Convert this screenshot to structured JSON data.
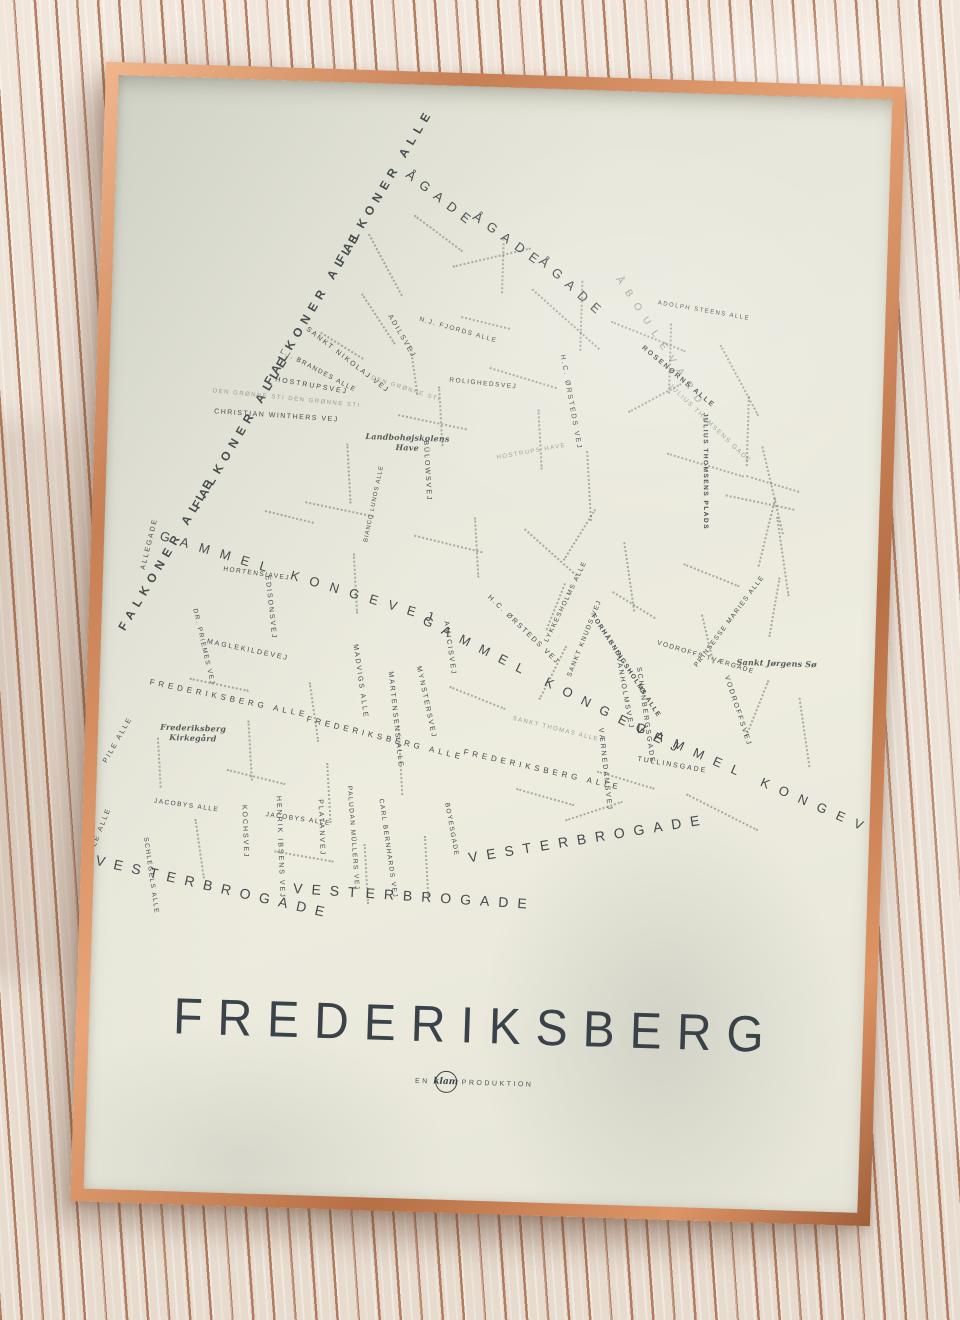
{
  "poster": {
    "title": "FREDERIKSBERG",
    "credit_prefix": "EN",
    "credit_logo": "klam",
    "credit_suffix": "PRODUKTION",
    "colors": {
      "paper": "#eae9dd",
      "ink": "#454b4c",
      "ink_light": "#9aa096",
      "frame_copper": "#c77f54",
      "fabric_base": "#eee3d8",
      "fabric_stripe": "#a86c4c"
    },
    "map": {
      "landmarks": [
        {
          "text": "Frederiksberg\nKirkegård",
          "x": 62,
          "y": 645
        },
        {
          "text": "Landbohøjskolens\nHave",
          "x": 258,
          "y": 348
        },
        {
          "text": "Sankt Jørgens Sø",
          "x": 636,
          "y": 562
        }
      ],
      "streets": [
        {
          "t": "ÅGADE",
          "x": 292,
          "y": 82,
          "r": 36,
          "s": 13,
          "ls": 8,
          "w": "n",
          "c": "dark"
        },
        {
          "t": "ÅGADE",
          "x": 360,
          "y": 122,
          "r": 34,
          "s": 13,
          "ls": 8,
          "w": "n",
          "c": "dark"
        },
        {
          "t": "ÅGADE",
          "x": 428,
          "y": 164,
          "r": 40,
          "s": 13,
          "ls": 8,
          "w": "n",
          "c": "dark"
        },
        {
          "t": "ÅBOULEVARD",
          "x": 505,
          "y": 182,
          "r": 55,
          "s": 10,
          "ls": 9,
          "w": "n",
          "c": "light"
        },
        {
          "t": "FALKONER ALLE",
          "x": 20,
          "y": 548,
          "r": -61,
          "s": 12,
          "ls": 6,
          "w": "b",
          "c": "dark"
        },
        {
          "t": "FALKONER ALLE",
          "x": 90,
          "y": 424,
          "r": -61,
          "s": 12,
          "ls": 6,
          "w": "b",
          "c": "dark"
        },
        {
          "t": "FALKONER ALLE",
          "x": 158,
          "y": 298,
          "r": -61,
          "s": 12,
          "ls": 6,
          "w": "b",
          "c": "dark"
        },
        {
          "t": "FALKONER ALLE",
          "x": 226,
          "y": 174,
          "r": -61,
          "s": 12,
          "ls": 6,
          "w": "b",
          "c": "dark"
        },
        {
          "t": "GAMMEL KONGEVEJ",
          "x": 56,
          "y": 452,
          "r": 15,
          "s": 13,
          "ls": 11,
          "w": "n",
          "c": "dark"
        },
        {
          "t": "GAMMEL KONGEVEJ",
          "x": 322,
          "y": 528,
          "r": 25,
          "s": 13,
          "ls": 11,
          "w": "n",
          "c": "dark"
        },
        {
          "t": "GAMMEL KONGEVEJ",
          "x": 538,
          "y": 628,
          "r": 22,
          "s": 13,
          "ls": 11,
          "w": "n",
          "c": "dark"
        },
        {
          "t": "FREDERIKSBERG ALLE",
          "x": 50,
          "y": 602,
          "r": 10,
          "s": 8,
          "ls": 4,
          "w": "n",
          "c": "dark"
        },
        {
          "t": "FREDERIKSBERG ALLE",
          "x": 208,
          "y": 634,
          "r": 12,
          "s": 8,
          "ls": 4,
          "w": "n",
          "c": "dark"
        },
        {
          "t": "FREDERIKSBERG ALLE",
          "x": 366,
          "y": 662,
          "r": 11,
          "s": 8,
          "ls": 4,
          "w": "n",
          "c": "dark"
        },
        {
          "t": "VESTERBROGADE",
          "x": 2,
          "y": 778,
          "r": 11,
          "s": 14,
          "ls": 9,
          "w": "n",
          "c": "dark"
        },
        {
          "t": "VESTERBROGADE",
          "x": 200,
          "y": 800,
          "r": 2,
          "s": 14,
          "ls": 9,
          "w": "n",
          "c": "dark"
        },
        {
          "t": "VESTERBROGADE",
          "x": 374,
          "y": 764,
          "r": -11,
          "s": 14,
          "ls": 9,
          "w": "n",
          "c": "dark"
        },
        {
          "t": "SANKT NIKOLAJ VEJ",
          "x": 196,
          "y": 244,
          "r": 36,
          "s": 7,
          "ls": 2,
          "w": "n",
          "c": "dark"
        },
        {
          "t": "HOSTRUPSVEJ",
          "x": 166,
          "y": 296,
          "r": 8,
          "s": 7,
          "ls": 2,
          "w": "n",
          "c": "dark"
        },
        {
          "t": "DEN GRØNNE STI DEN GRØNNE STI",
          "x": 104,
          "y": 310,
          "r": 4,
          "s": 6,
          "ls": 1.5,
          "w": "n",
          "c": "light"
        },
        {
          "t": "CHRISTIAN WINTHERS VEJ",
          "x": 106,
          "y": 330,
          "r": 2,
          "s": 7,
          "ls": 1.5,
          "w": "n",
          "c": "dark"
        },
        {
          "t": "ADILSVEJ",
          "x": 278,
          "y": 228,
          "r": 58,
          "s": 7,
          "ls": 2,
          "w": "n",
          "c": "dark"
        },
        {
          "t": "L.I. BRANDES ALLE",
          "x": 170,
          "y": 268,
          "r": 26,
          "s": 6.5,
          "ls": 1.5,
          "w": "n",
          "c": "dark"
        },
        {
          "t": "N.J. FJORDS ALLE",
          "x": 308,
          "y": 232,
          "r": 14,
          "s": 6.5,
          "ls": 1.5,
          "w": "n",
          "c": "dark"
        },
        {
          "t": "DEN GRØNNE STI",
          "x": 262,
          "y": 292,
          "r": 16,
          "s": 6,
          "ls": 1.5,
          "w": "n",
          "c": "light"
        },
        {
          "t": "ROLIGHEDSVEJ",
          "x": 340,
          "y": 292,
          "r": 4,
          "s": 6.5,
          "ls": 1.5,
          "w": "n",
          "c": "dark"
        },
        {
          "t": "BÜLOWSVEJ",
          "x": 318,
          "y": 352,
          "r": 85,
          "s": 7,
          "ls": 2,
          "w": "n",
          "c": "dark"
        },
        {
          "t": "HOSTRUPS HAVE",
          "x": 390,
          "y": 368,
          "r": -12,
          "s": 6,
          "ls": 1.5,
          "w": "n",
          "c": "light"
        },
        {
          "t": "H.C. ØRSTEDS VEJ",
          "x": 452,
          "y": 262,
          "r": 78,
          "s": 7,
          "ls": 2,
          "w": "n",
          "c": "dark"
        },
        {
          "t": "H.C. ØRSTEDS VEJ",
          "x": 386,
          "y": 506,
          "r": 42,
          "s": 7,
          "ls": 2,
          "w": "n",
          "c": "dark"
        },
        {
          "t": "JULIUS THOMSENS GADE",
          "x": 560,
          "y": 290,
          "r": 42,
          "s": 6.5,
          "ls": 1.5,
          "w": "n",
          "c": "light"
        },
        {
          "t": "JULIUS THOMSENS PLADS",
          "x": 596,
          "y": 316,
          "r": 88,
          "s": 6.5,
          "ls": 1.5,
          "w": "b",
          "c": "dark"
        },
        {
          "t": "ADOLPH STEENS ALLE",
          "x": 546,
          "y": 208,
          "r": 8,
          "s": 6,
          "ls": 1.5,
          "w": "n",
          "c": "dark"
        },
        {
          "t": "ROSENØRNS ALLE",
          "x": 532,
          "y": 252,
          "r": 38,
          "s": 7,
          "ls": 2,
          "w": "b",
          "c": "dark"
        },
        {
          "t": "FORHÅBNINGSHOLMS ALLE",
          "x": 490,
          "y": 522,
          "r": 55,
          "s": 6.5,
          "ls": 1.5,
          "w": "b",
          "c": "dark"
        },
        {
          "t": "VODROFFS TVÆRGADE",
          "x": 556,
          "y": 548,
          "r": 15,
          "s": 6.5,
          "ls": 1.5,
          "w": "n",
          "c": "dark"
        },
        {
          "t": "VODROFFSVEJ",
          "x": 626,
          "y": 578,
          "r": 70,
          "s": 7,
          "ls": 2,
          "w": "n",
          "c": "dark"
        },
        {
          "t": "SVANHOLMSVEJ",
          "x": 516,
          "y": 556,
          "r": 78,
          "s": 7,
          "ls": 2,
          "w": "n",
          "c": "dark"
        },
        {
          "t": "SCHØNBERGSGADE",
          "x": 538,
          "y": 572,
          "r": 80,
          "s": 7,
          "ls": 2,
          "w": "n",
          "c": "dark"
        },
        {
          "t": "PRINSESSE MARIES ALLE",
          "x": 596,
          "y": 570,
          "r": -55,
          "s": 6.5,
          "ls": 1.5,
          "w": "n",
          "c": "dark"
        },
        {
          "t": "LYKKESHOLMS ALLE",
          "x": 446,
          "y": 550,
          "r": -66,
          "s": 6.5,
          "ls": 1.5,
          "w": "n",
          "c": "dark"
        },
        {
          "t": "SANKT KNUDS VEJ",
          "x": 470,
          "y": 584,
          "r": -70,
          "s": 6.5,
          "ls": 1.5,
          "w": "n",
          "c": "dark"
        },
        {
          "t": "BIANCO LUNOS ALLE",
          "x": 262,
          "y": 456,
          "r": -80,
          "s": 6,
          "ls": 1,
          "w": "n",
          "c": "dark"
        },
        {
          "t": "EDISONSVEJ",
          "x": 164,
          "y": 492,
          "r": 82,
          "s": 7,
          "ls": 2,
          "w": "n",
          "c": "dark"
        },
        {
          "t": "HORTENSIAVEJ",
          "x": 120,
          "y": 488,
          "r": 6,
          "s": 6.5,
          "ls": 1.5,
          "w": "n",
          "c": "dark"
        },
        {
          "t": "MAGLEKILDEVEJ",
          "x": 106,
          "y": 560,
          "r": 10,
          "s": 7,
          "ls": 2,
          "w": "n",
          "c": "dark"
        },
        {
          "t": "DR. PRIEMES VEJ",
          "x": 92,
          "y": 528,
          "r": 75,
          "s": 6.5,
          "ls": 1.5,
          "w": "n",
          "c": "dark"
        },
        {
          "t": "ALLEGADE",
          "x": 40,
          "y": 490,
          "r": -78,
          "s": 7,
          "ls": 2,
          "w": "n",
          "c": "dark"
        },
        {
          "t": "AMICISVEJ",
          "x": 344,
          "y": 532,
          "r": 80,
          "s": 7,
          "ls": 2,
          "w": "n",
          "c": "dark"
        },
        {
          "t": "MADVIGS ALLE",
          "x": 254,
          "y": 558,
          "r": 80,
          "s": 7,
          "ls": 2,
          "w": "n",
          "c": "dark"
        },
        {
          "t": "MARTENSENS ALLE",
          "x": 290,
          "y": 584,
          "r": 82,
          "s": 7,
          "ls": 2,
          "w": "n",
          "c": "dark"
        },
        {
          "t": "MYNSTERSVEJ",
          "x": 318,
          "y": 578,
          "r": 76,
          "s": 7,
          "ls": 2,
          "w": "n",
          "c": "dark"
        },
        {
          "t": "VÆRNEDAMSVEJ",
          "x": 502,
          "y": 634,
          "r": 82,
          "s": 7,
          "ls": 2,
          "w": "n",
          "c": "dark"
        },
        {
          "t": "TULLINSGADE",
          "x": 540,
          "y": 664,
          "r": 8,
          "s": 7,
          "ls": 2,
          "w": "n",
          "c": "dark"
        },
        {
          "t": "JACOBYS ALLE",
          "x": 58,
          "y": 722,
          "r": 6,
          "s": 6.5,
          "ls": 1.5,
          "w": "n",
          "c": "dark"
        },
        {
          "t": "JACOBYS ALLE",
          "x": 170,
          "y": 732,
          "r": 6,
          "s": 6.5,
          "ls": 1.5,
          "w": "n",
          "c": "dark"
        },
        {
          "t": "SCHLEGELS ALLE",
          "x": 50,
          "y": 758,
          "r": 80,
          "s": 6.5,
          "ls": 1.5,
          "w": "n",
          "c": "dark"
        },
        {
          "t": "PILE ALLE",
          "x": 8,
          "y": 684,
          "r": -62,
          "s": 7,
          "ls": 2,
          "w": "n",
          "c": "dark"
        },
        {
          "t": "PILE ALLE",
          "x": -4,
          "y": 778,
          "r": -70,
          "s": 7,
          "ls": 2,
          "w": "n",
          "c": "dark"
        },
        {
          "t": "KOCHSVEJ",
          "x": 148,
          "y": 722,
          "r": 86,
          "s": 7,
          "ls": 2,
          "w": "n",
          "c": "dark"
        },
        {
          "t": "HENRIK IBSENS VEJ",
          "x": 182,
          "y": 712,
          "r": 86,
          "s": 7,
          "ls": 2,
          "w": "n",
          "c": "dark"
        },
        {
          "t": "PLATANVEJ",
          "x": 224,
          "y": 714,
          "r": 86,
          "s": 7,
          "ls": 2,
          "w": "n",
          "c": "dark"
        },
        {
          "t": "PALUDAN MÜLLERS VEJ",
          "x": 252,
          "y": 700,
          "r": 84,
          "s": 6.5,
          "ls": 1.5,
          "w": "n",
          "c": "dark"
        },
        {
          "t": "CARL BERNHARDS VEJ",
          "x": 284,
          "y": 712,
          "r": 80,
          "s": 6.5,
          "ls": 1.5,
          "w": "n",
          "c": "dark"
        },
        {
          "t": "BOYESGADE",
          "x": 350,
          "y": 714,
          "r": 78,
          "s": 6.5,
          "ls": 1.5,
          "w": "n",
          "c": "dark"
        },
        {
          "t": "SANKT THOMAS ALLE",
          "x": 414,
          "y": 628,
          "r": 12,
          "s": 6,
          "ls": 1.5,
          "w": "n",
          "c": "light"
        }
      ]
    }
  }
}
